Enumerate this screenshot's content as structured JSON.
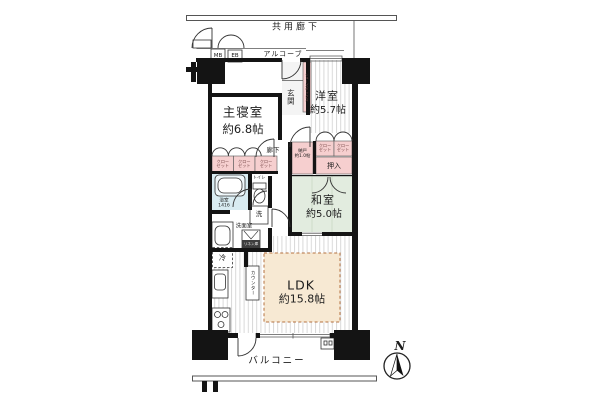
{
  "floorplan": {
    "common_corridor": "共用廊下",
    "alcove": "アルコーブ",
    "meter_box": "MB",
    "electric_box": "EB",
    "entrance": "玄関",
    "shoe_box": "シューズボックス",
    "hallway": "廊下",
    "rooms": {
      "master_bedroom": {
        "name": "主寝室",
        "size": "約6.8帖"
      },
      "western_room": {
        "name": "洋室",
        "size": "約5.7帖"
      },
      "japanese_room": {
        "name": "和室",
        "size": "約5.0帖"
      },
      "ldk": {
        "name": "LDK",
        "size": "約15.8帖"
      }
    },
    "storage": {
      "nando": {
        "name": "納戸",
        "size": "約1.0帖"
      },
      "closet": {
        "line1": "クロー",
        "line2": "ゼット"
      },
      "oshiire": "押入",
      "linen": "リネン庫"
    },
    "sanitary": {
      "bathroom": {
        "name": "浴室",
        "size": "1416"
      },
      "toilet": "トイレ",
      "washer": "洗",
      "powder_room": "洗面室"
    },
    "kitchen": {
      "fridge": "冷",
      "counter": "カウンター"
    },
    "balcony": "バルコニー",
    "compass_north": "N",
    "colors": {
      "wall": "#141414",
      "tatami_green": "#e2ecdf",
      "bath_blue": "#d9ecf2",
      "closet_pink": "#f6cfcf",
      "ldk_beige": "#f7e9d3",
      "ldk_dash": "#b5713f"
    }
  }
}
